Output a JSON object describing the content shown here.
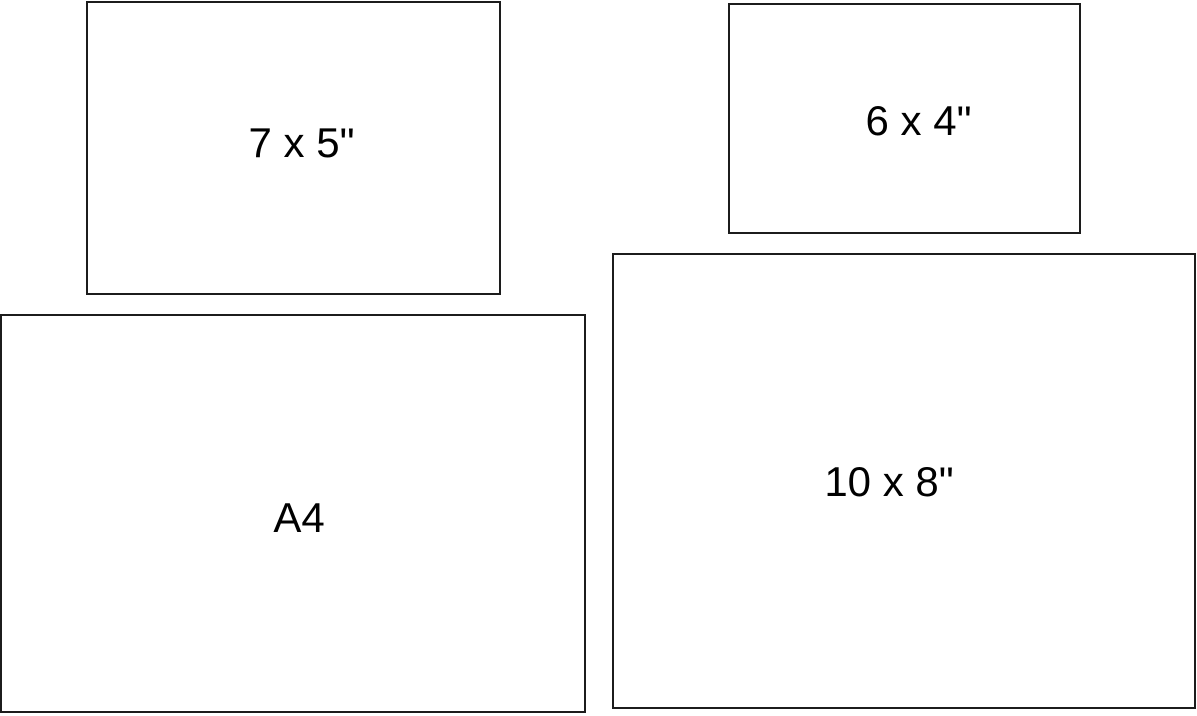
{
  "diagram": {
    "background_color": "#ffffff",
    "border_color": "#1c1c1c",
    "text_color": "#000000",
    "sizes": [
      {
        "id": "7x5",
        "label": "7 x 5\""
      },
      {
        "id": "6x4",
        "label": "6 x 4\""
      },
      {
        "id": "a4",
        "label": "A4"
      },
      {
        "id": "10x8",
        "label": "10 x 8\""
      }
    ]
  }
}
